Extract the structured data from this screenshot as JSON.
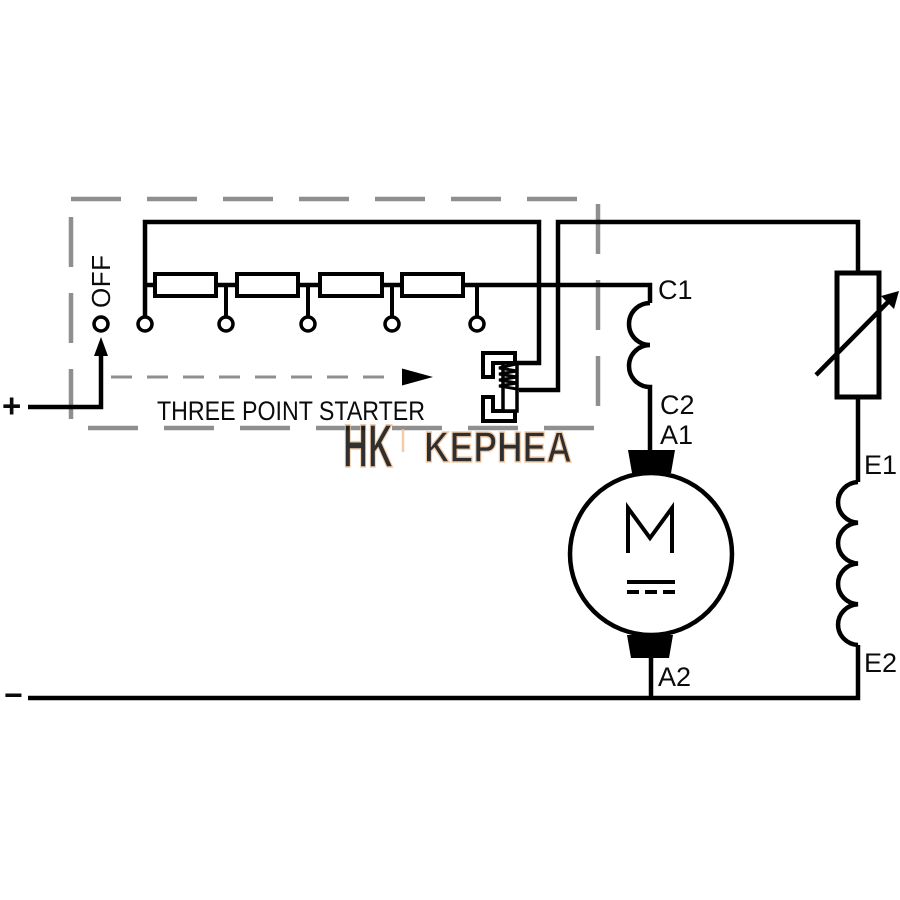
{
  "colors": {
    "wire": "#000000",
    "enclosure_dash": "#8f8f8f",
    "background": "#ffffff",
    "watermark": "#f0c49c"
  },
  "labels": {
    "supply_positive": "+",
    "supply_negative": "−",
    "off": "OFF",
    "starter_caption": "THREE POINT STARTER",
    "series_field_start": "C1",
    "series_field_end": "C2",
    "armature_start": "A1",
    "armature_end": "A2",
    "shunt_field_start": "E1",
    "shunt_field_end": "E2",
    "motor_symbol": "M"
  },
  "watermark": {
    "logo": "HK",
    "text": "KEPHEA"
  }
}
